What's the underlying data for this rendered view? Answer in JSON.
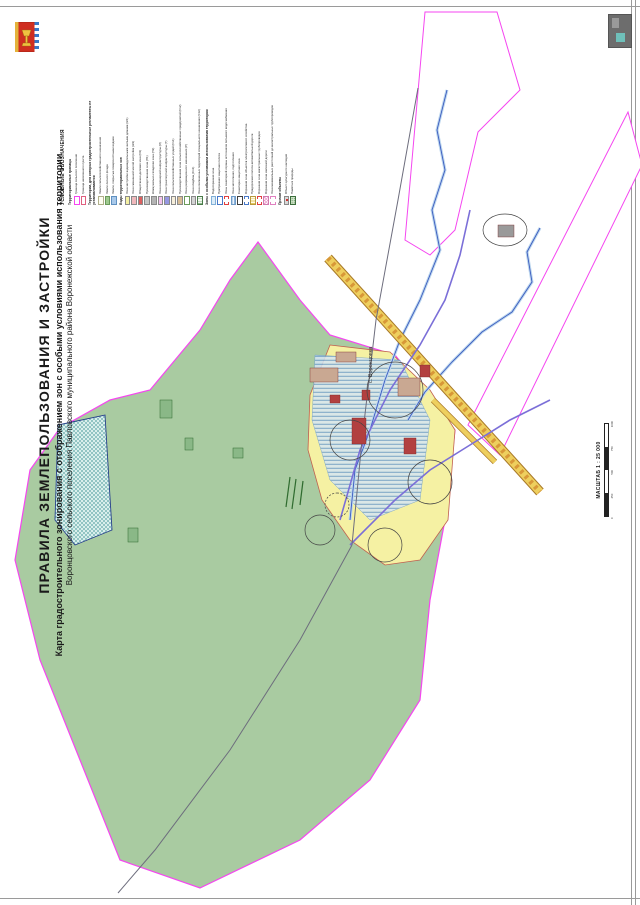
{
  "title": {
    "line1": "ПРАВИЛА ЗЕМЛЕПОЛЬЗОВАНИЯ И ЗАСТРОЙКИ",
    "line2": "Карта градостроительного зонирования с отображением зон с особыми условиями использования территории",
    "line3": "Воронцовского сельского поселения Павловского муниципального района Воронежской области"
  },
  "legend": {
    "title": "УСЛОВНЫЕ ОБОЗНАЧЕНИЯ",
    "groups": [
      {
        "title": "Территориальные границы",
        "items": [
          {
            "label": "Граница сельского поселения",
            "fill": "#ffffff",
            "border": "#f546f0"
          },
          {
            "label": "Граница населенного пункта",
            "fill": "#ffffff",
            "border": "#e06080"
          }
        ]
      },
      {
        "title": "Территории, для которых градостроительные регламенты не устанавливаются",
        "items": [
          {
            "label": "Земли сельскохозяйственного назначения",
            "fill": "#fdfdf2",
            "border": "#b0b08a"
          },
          {
            "label": "Земли лесного фонда",
            "fill": "#9fca8f",
            "border": "#6a9a5a"
          },
          {
            "label": "Земли, покрытые поверхностными водами",
            "fill": "#a9c9ea",
            "border": "#6090c0"
          }
        ]
      },
      {
        "title": "Виды территориальных зон",
        "items": [
          {
            "label": "Зона застройки индивидуальными жилыми домами (Ж1)",
            "fill": "#f5f1a3"
          },
          {
            "label": "Зона смешанной жилой застройки (Ж2)",
            "fill": "#f0b8bc"
          },
          {
            "label": "Общественно-деловая зона (О1)",
            "fill": "#dd5f5f"
          },
          {
            "label": "Производственная зона (П1)",
            "fill": "#c6c6c6"
          },
          {
            "label": "Коммунально-складская зона (П2)",
            "fill": "#b4b4b4"
          },
          {
            "label": "Зона инженерной инфраструктуры (И)",
            "fill": "#f2c2ee"
          },
          {
            "label": "Зона транспортной инфраструктуры (Т)",
            "fill": "#9697e2"
          },
          {
            "label": "Зона сельскохозяйственных угодий (Сх1)",
            "fill": "#f6eeda"
          },
          {
            "label": "Производственная зона сельскохозяйственных предприятий (Сх2)",
            "fill": "#d9bd95"
          },
          {
            "label": "Зона рекреационного назначения (Р)",
            "fill": "#ffffff",
            "border": "#6a9a5a"
          },
          {
            "label": "Зона кладбищ (Сп1)",
            "pattern": "dots"
          },
          {
            "label": "Зона озелененных территорий специального назначения (Сп2)",
            "pattern": "hatch-green",
            "border": "#4a7a4a"
          }
        ]
      },
      {
        "title": "Зоны с особыми условиями использования территории",
        "items": [
          {
            "label": "Водоохранная зона",
            "fill": "#dcecf8",
            "border": "#80b0d8"
          },
          {
            "label": "Прибрежная защитная полоса",
            "fill": "#ffffff",
            "border": "#4878c8"
          },
          {
            "label": "Зоны санитарной охраны источников питьевого водоснабжения",
            "fill": "#ffffff",
            "border": "#e04040",
            "dash": true
          },
          {
            "label": "Зона затопления, подтопления",
            "pattern": "stripes-blue",
            "border": "#6f9cc8"
          },
          {
            "label": "Санитарно-защитная зона",
            "fill": "#ffffff",
            "border": "#404040"
          },
          {
            "label": "Охранная зона объектов электросетевого хозяйства",
            "fill": "#ffffff",
            "border": "#4878c8",
            "dash": true
          },
          {
            "label": "Придорожная полоса автомобильной дороги",
            "pattern": "stripes-yellow",
            "border": "#b89a3c"
          },
          {
            "label": "Охранная зона магистральных трубопроводов",
            "fill": "#ffffff",
            "border": "#e04040",
            "dash": true
          },
          {
            "label": "Охранная зона железной дороги",
            "pattern": "crosshatch-pink",
            "border": "#d07ab0"
          },
          {
            "label": "Зона минимальных расстояний до магистральных трубопроводов",
            "fill": "#ffffff",
            "border": "#e080c0",
            "dash": true
          }
        ]
      },
      {
        "title": "Прочие объекты",
        "items": [
          {
            "label": "Объект культурного наследия",
            "symbol": "red-dot"
          },
          {
            "label": "Памятник природы",
            "symbol": "green-dot"
          }
        ]
      }
    ]
  },
  "scale": {
    "label": "МАСШТАБ 1 : 25 000",
    "ticks": [
      "0",
      "250",
      "500",
      "750",
      "1000"
    ]
  },
  "map": {
    "settlement_label": "с. Воронцовка",
    "colors": {
      "municipal_land": "#a9cba1",
      "settlement_boundary": "#f546f0",
      "residential": "#f5f1a3",
      "flood_zone": "#7ea9d4",
      "river": "#3b5bbf",
      "highway": "#eecf5e",
      "pipeline": "#7b6fd8",
      "built": "#b24040"
    }
  }
}
